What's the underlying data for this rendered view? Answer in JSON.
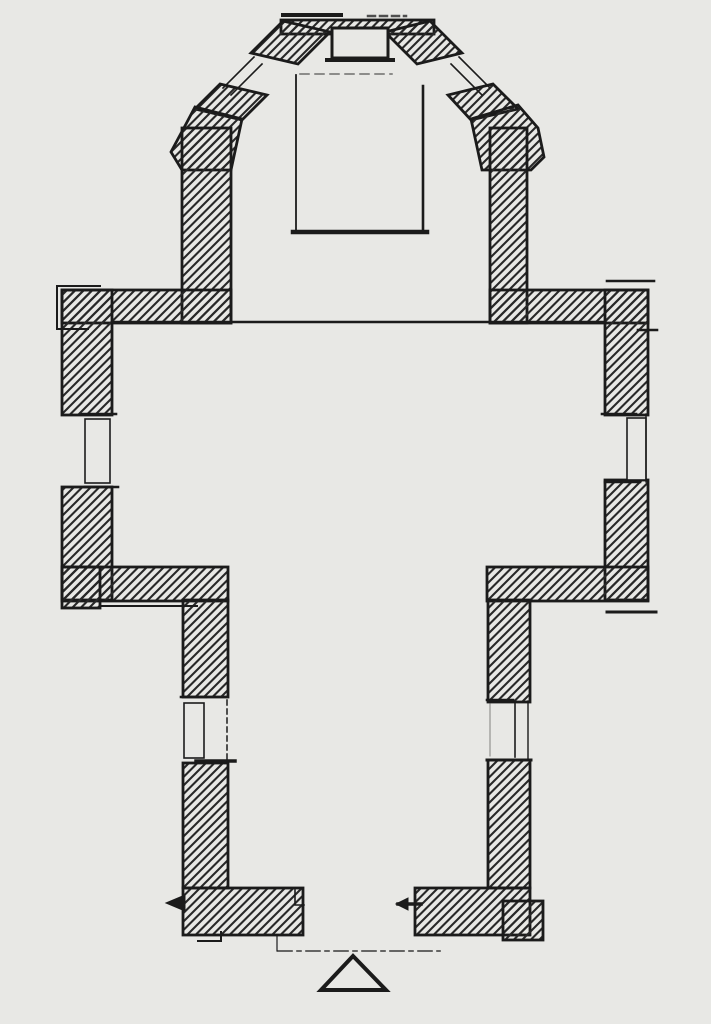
{
  "document": {
    "type": "architectural-floor-plan",
    "description": "Hand-drawn ground plan of a small church: polygonal apse with angled windowed walls at the top, a wide transept crossing with windows in the east and west walls, a narrower nave with one window in each side wall, and a south entrance marked by a dashed axis line and an open triangle symbol",
    "visible_text": []
  },
  "canvas": {
    "width": 711,
    "height": 1024,
    "paper_color": "#e8e8e5",
    "ink_color": "#1b1b1b"
  },
  "hatch": {
    "name": "wall-hatch-45deg",
    "spacing": 8.5,
    "stroke_width": 2.1,
    "color": "#282828"
  },
  "plan": {
    "shapes": [
      {
        "name": "apse-top-wall",
        "kind": "rect",
        "x": 281,
        "y": 20,
        "wd": 153,
        "ht": 14,
        "fill": "hatch",
        "w": 2.8
      },
      {
        "name": "apse-diagonal-wall-left-upper",
        "kind": "poly",
        "pts": [
          283,
          21,
          330,
          32,
          298,
          64,
          251,
          53
        ],
        "fill": "hatch",
        "w": 2.8
      },
      {
        "name": "apse-diagonal-wall-left-lower",
        "kind": "poly",
        "pts": [
          220,
          84,
          267,
          95,
          242,
          120,
          195,
          109
        ],
        "fill": "hatch",
        "w": 2.8
      },
      {
        "name": "apse-buttress-left",
        "kind": "poly",
        "pts": [
          195,
          107,
          242,
          119,
          231,
          170,
          182,
          170,
          171,
          152,
          186,
          124
        ],
        "fill": "hatch",
        "w": 2.8
      },
      {
        "name": "apse-side-wall-left",
        "kind": "rect",
        "x": 182,
        "y": 128,
        "wd": 49,
        "ht": 195,
        "fill": "hatch",
        "w": 2.8
      },
      {
        "name": "apse-diagonal-wall-right-upper",
        "kind": "poly",
        "pts": [
          430,
          21,
          385,
          32,
          417,
          64,
          462,
          53
        ],
        "fill": "hatch",
        "w": 2.8
      },
      {
        "name": "apse-diagonal-wall-right-lower",
        "kind": "poly",
        "pts": [
          493,
          84,
          448,
          95,
          471,
          120,
          518,
          109
        ],
        "fill": "hatch",
        "w": 2.8
      },
      {
        "name": "apse-buttress-right",
        "kind": "poly",
        "pts": [
          518,
          105,
          471,
          119,
          482,
          170,
          531,
          170,
          544,
          157,
          538,
          128
        ],
        "fill": "hatch",
        "w": 2.8
      },
      {
        "name": "apse-side-wall-right",
        "kind": "rect",
        "x": 490,
        "y": 128,
        "wd": 37,
        "ht": 195,
        "fill": "hatch",
        "w": 2.8
      },
      {
        "name": "transept-north-wall-left",
        "kind": "rect",
        "x": 62,
        "y": 290,
        "wd": 169,
        "ht": 33,
        "fill": "hatch",
        "w": 2.8
      },
      {
        "name": "transept-north-wall-right",
        "kind": "rect",
        "x": 490,
        "y": 290,
        "wd": 158,
        "ht": 33,
        "fill": "hatch",
        "w": 2.8
      },
      {
        "name": "transept-west-wall-upper",
        "kind": "rect",
        "x": 62,
        "y": 290,
        "wd": 50,
        "ht": 125,
        "fill": "hatch",
        "w": 2.8
      },
      {
        "name": "transept-west-wall-lower",
        "kind": "rect",
        "x": 62,
        "y": 487,
        "wd": 50,
        "ht": 113,
        "fill": "hatch",
        "w": 2.8
      },
      {
        "name": "transept-east-wall-upper",
        "kind": "rect",
        "x": 605,
        "y": 290,
        "wd": 43,
        "ht": 125,
        "fill": "hatch",
        "w": 2.8
      },
      {
        "name": "transept-east-wall-lower",
        "kind": "rect",
        "x": 605,
        "y": 480,
        "wd": 43,
        "ht": 120,
        "fill": "hatch",
        "w": 2.8
      },
      {
        "name": "transept-south-wall-left",
        "kind": "rect",
        "x": 62,
        "y": 567,
        "wd": 166,
        "ht": 34,
        "fill": "hatch",
        "w": 2.8
      },
      {
        "name": "transept-south-foot-left",
        "kind": "rect",
        "x": 62,
        "y": 567,
        "wd": 38,
        "ht": 41,
        "fill": "hatch",
        "w": 2.8
      },
      {
        "name": "transept-south-wall-right",
        "kind": "rect",
        "x": 487,
        "y": 567,
        "wd": 161,
        "ht": 34,
        "fill": "hatch",
        "w": 2.8
      },
      {
        "name": "nave-west-wall-upper",
        "kind": "rect",
        "x": 183,
        "y": 600,
        "wd": 45,
        "ht": 97,
        "fill": "hatch",
        "w": 2.8
      },
      {
        "name": "nave-west-wall-lower",
        "kind": "rect",
        "x": 183,
        "y": 763,
        "wd": 45,
        "ht": 125,
        "fill": "hatch",
        "w": 2.8
      },
      {
        "name": "nave-east-wall-upper",
        "kind": "rect",
        "x": 488,
        "y": 600,
        "wd": 42,
        "ht": 102,
        "fill": "hatch",
        "w": 2.8
      },
      {
        "name": "nave-east-wall-lower",
        "kind": "rect",
        "x": 488,
        "y": 760,
        "wd": 42,
        "ht": 128,
        "fill": "hatch",
        "w": 2.8
      },
      {
        "name": "facade-wall-left",
        "kind": "rect",
        "x": 183,
        "y": 888,
        "wd": 120,
        "ht": 47,
        "fill": "hatch",
        "w": 2.8
      },
      {
        "name": "facade-wall-right",
        "kind": "rect",
        "x": 415,
        "y": 888,
        "wd": 115,
        "ht": 47,
        "fill": "hatch",
        "w": 2.8
      },
      {
        "name": "facade-foot-right",
        "kind": "rect",
        "x": 503,
        "y": 901,
        "wd": 40,
        "ht": 39,
        "fill": "hatch",
        "w": 2.8
      },
      {
        "name": "apse-altar-niche",
        "kind": "rect",
        "x": 332,
        "y": 28,
        "wd": 56,
        "ht": 30,
        "fill": "paper",
        "w": 3
      },
      {
        "name": "apse-niche-sill",
        "kind": "line",
        "pts": [
          327,
          60,
          393,
          60
        ],
        "w": 4
      },
      {
        "name": "apse-roof-line-left",
        "kind": "line",
        "pts": [
          283,
          15,
          341,
          15
        ],
        "w": 4
      },
      {
        "name": "apse-roof-line-right",
        "kind": "line",
        "pts": [
          368,
          16,
          406,
          16
        ],
        "w": 2.5,
        "dash": "7 5",
        "op": 0.75
      },
      {
        "name": "choir-platform-left-edge",
        "kind": "line",
        "pts": [
          296,
          75,
          296,
          232
        ],
        "w": 1.8
      },
      {
        "name": "choir-platform-right-edge",
        "kind": "line",
        "pts": [
          423,
          86,
          423,
          232
        ],
        "w": 2.6
      },
      {
        "name": "choir-platform-top-edge",
        "kind": "line",
        "pts": [
          300,
          74,
          392,
          74
        ],
        "w": 1.5,
        "dash": "9 6",
        "op": 0.6
      },
      {
        "name": "choir-platform-bottom-edge",
        "kind": "line",
        "pts": [
          293,
          232,
          427,
          232
        ],
        "w": 4.5
      },
      {
        "name": "chancel-step-line",
        "kind": "line",
        "pts": [
          112,
          322,
          605,
          322
        ],
        "w": 2.6
      },
      {
        "name": "apse-window-left-glazing-a",
        "kind": "line",
        "pts": [
          254,
          57,
          223,
          88
        ],
        "w": 1.6
      },
      {
        "name": "apse-window-left-glazing-b",
        "kind": "line",
        "pts": [
          262,
          64,
          231,
          95
        ],
        "w": 1.6
      },
      {
        "name": "apse-window-right-glazing-a",
        "kind": "line",
        "pts": [
          459,
          57,
          490,
          88
        ],
        "w": 1.6
      },
      {
        "name": "apse-window-right-glazing-b",
        "kind": "line",
        "pts": [
          451,
          64,
          482,
          95
        ],
        "w": 1.6
      },
      {
        "name": "transept-window-west-jamb-top",
        "kind": "line",
        "pts": [
          82,
          414,
          116,
          414
        ],
        "w": 2.6
      },
      {
        "name": "transept-window-west-jamb-bottom",
        "kind": "line",
        "pts": [
          85,
          487,
          118,
          487
        ],
        "w": 2.6
      },
      {
        "name": "transept-window-west-frame",
        "kind": "rect",
        "x": 85,
        "y": 419,
        "wd": 25,
        "ht": 64,
        "fill": "paper",
        "w": 1.6
      },
      {
        "name": "transept-window-east-jamb-top",
        "kind": "line",
        "pts": [
          602,
          414,
          636,
          414
        ],
        "w": 2.6
      },
      {
        "name": "transept-window-east-jamb-bottom",
        "kind": "line",
        "pts": [
          605,
          482,
          640,
          482
        ],
        "w": 2.6
      },
      {
        "name": "transept-window-east-frame",
        "kind": "rect",
        "x": 627,
        "y": 418,
        "wd": 19,
        "ht": 62,
        "fill": "paper",
        "w": 1.6
      },
      {
        "name": "transept-window-east-outer-line",
        "kind": "line",
        "pts": [
          646,
          414,
          646,
          482
        ],
        "w": 1.4
      },
      {
        "name": "north-wall-left-step",
        "kind": "pline",
        "pts": [
          100,
          286,
          57,
          286,
          57,
          329,
          88,
          329
        ],
        "w": 2
      },
      {
        "name": "north-wall-right-parapet",
        "kind": "line",
        "pts": [
          607,
          281,
          654,
          281
        ],
        "w": 2.6
      },
      {
        "name": "north-wall-right-tick",
        "kind": "line",
        "pts": [
          638,
          330,
          657,
          330
        ],
        "w": 2.6
      },
      {
        "name": "south-wall-left-plinth",
        "kind": "line",
        "pts": [
          100,
          606,
          197,
          606
        ],
        "w": 2
      },
      {
        "name": "south-wall-right-plinth",
        "kind": "line",
        "pts": [
          607,
          612,
          656,
          612
        ],
        "w": 3
      },
      {
        "name": "nave-window-west-jamb-top",
        "kind": "line",
        "pts": [
          181,
          697,
          206,
          697
        ],
        "w": 2.6
      },
      {
        "name": "nave-window-west-sill",
        "kind": "line",
        "pts": [
          196,
          761,
          235,
          761
        ],
        "w": 3.5
      },
      {
        "name": "nave-window-west-frame",
        "kind": "rect",
        "x": 184,
        "y": 703,
        "wd": 20,
        "ht": 55,
        "fill": "paper",
        "w": 1.6
      },
      {
        "name": "nave-window-west-dashed-reveal",
        "kind": "line",
        "pts": [
          227,
          700,
          227,
          760
        ],
        "w": 1.5,
        "dash": "5 4"
      },
      {
        "name": "nave-window-east-jamb-top",
        "kind": "line",
        "pts": [
          487,
          700,
          513,
          700
        ],
        "w": 2.6
      },
      {
        "name": "nave-window-east-sill",
        "kind": "line",
        "pts": [
          487,
          760,
          531,
          760
        ],
        "w": 3
      },
      {
        "name": "nave-window-east-mullion",
        "kind": "line",
        "pts": [
          515,
          703,
          515,
          757
        ],
        "w": 1.6
      },
      {
        "name": "nave-window-east-outer-line",
        "kind": "line",
        "pts": [
          528,
          701,
          528,
          759
        ],
        "w": 1.4
      },
      {
        "name": "nave-window-east-inner-line",
        "kind": "line",
        "pts": [
          490,
          704,
          490,
          756
        ],
        "w": 1,
        "op": 0.5
      },
      {
        "name": "door-jamb-left-rebate",
        "kind": "pline",
        "pts": [
          295,
          890,
          295,
          905,
          304,
          905
        ],
        "w": 1.6
      },
      {
        "name": "section-marker-left",
        "kind": "poly",
        "pts": [
          166,
          903,
          185,
          895,
          185,
          911
        ],
        "fill": "ink",
        "w": 1
      },
      {
        "name": "section-marker-right-line",
        "kind": "line",
        "pts": [
          398,
          904,
          421,
          904
        ],
        "w": 3.5
      },
      {
        "name": "section-marker-right-head",
        "kind": "poly",
        "pts": [
          396,
          904,
          408,
          898,
          408,
          910
        ],
        "fill": "ink",
        "w": 1
      },
      {
        "name": "facade-step-left",
        "kind": "pline",
        "pts": [
          198,
          941,
          221,
          941,
          221,
          932
        ],
        "w": 2
      },
      {
        "name": "door-axis-drop",
        "kind": "line",
        "pts": [
          277,
          935,
          277,
          951
        ],
        "w": 1.2
      },
      {
        "name": "door-axis-dashed",
        "kind": "line",
        "pts": [
          278,
          951,
          440,
          951
        ],
        "w": 1.6,
        "dash": "14 5 4 5",
        "op": 0.85
      },
      {
        "name": "entrance-triangle",
        "kind": "poly",
        "pts": [
          353,
          956,
          386,
          990,
          321,
          990
        ],
        "fill": "paper",
        "w": 4
      }
    ]
  }
}
